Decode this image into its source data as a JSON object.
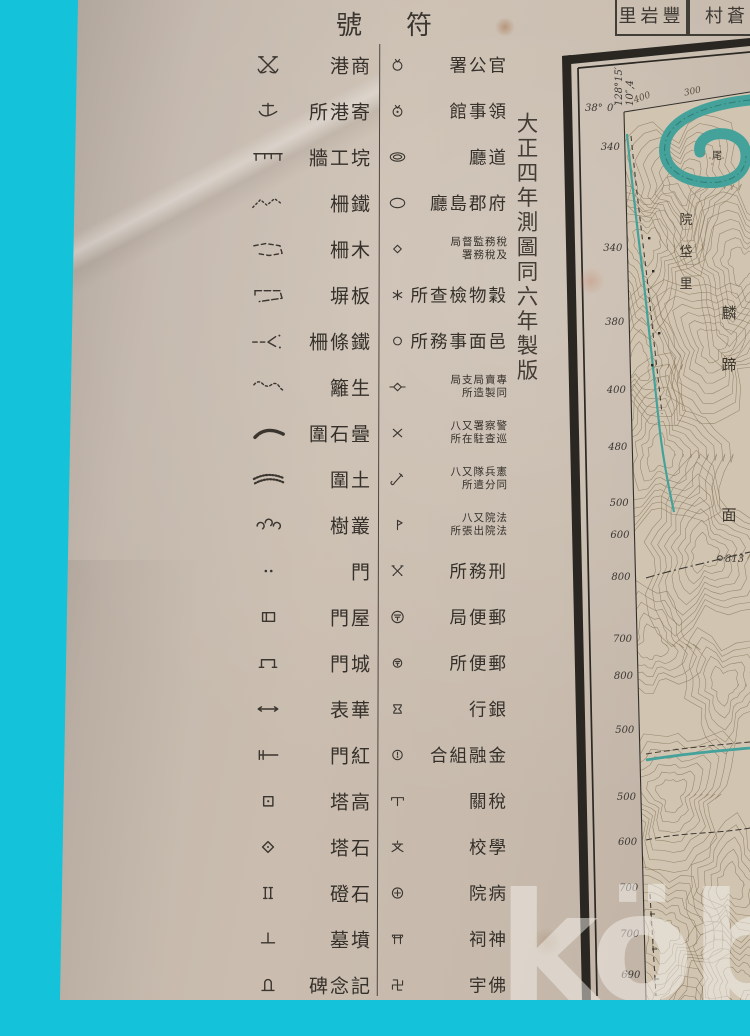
{
  "scene": {
    "background_color": "#14c2d9",
    "paper_color": "#c4b9ad",
    "ink_color": "#35302a",
    "water_color": "#45a29a",
    "contour_color": "#8a795d"
  },
  "legend": {
    "title_display": "號符",
    "rows": [
      {
        "left": {
          "symbol": "crossed-anchors",
          "label": "港商"
        },
        "right": {
          "symbol": "circle-ticks",
          "label": "署公官"
        }
      },
      {
        "left": {
          "symbol": "anchor",
          "label": "所港寄"
        },
        "right": {
          "symbol": "circle-dot-ticks",
          "label": "館事領"
        }
      },
      {
        "left": {
          "symbol": "masonry-wall",
          "label": "牆工垸"
        },
        "right": {
          "symbol": "double-ellipse",
          "label": "廳道"
        }
      },
      {
        "left": {
          "symbol": "iron-fence",
          "label": "柵鐵"
        },
        "right": {
          "symbol": "ellipse",
          "label": "廳島郡府"
        }
      },
      {
        "left": {
          "symbol": "wood-fence",
          "label": "柵木"
        },
        "right": {
          "symbol": "small-diamond",
          "label": "局督監務稅",
          "label2": "署務稅及"
        }
      },
      {
        "left": {
          "symbol": "board-fence",
          "label": "塀板"
        },
        "right": {
          "symbol": "grain-check",
          "label": "所查檢物穀"
        }
      },
      {
        "left": {
          "symbol": "wire-fence",
          "label": "柵條鐵"
        },
        "right": {
          "symbol": "small-circle",
          "label": "所務事面邑"
        }
      },
      {
        "left": {
          "symbol": "hedge",
          "label": "籬生"
        },
        "right": {
          "symbol": "diamond-bars",
          "label": "局支局賣專",
          "label2": "所造製同"
        }
      },
      {
        "left": {
          "symbol": "stone-enclosure",
          "label": "圍石曡"
        },
        "right": {
          "symbol": "x-mark",
          "label": "八又署察警",
          "label2": "所在駐查巡"
        }
      },
      {
        "left": {
          "symbol": "earth-enclosure",
          "label": "圍土"
        },
        "right": {
          "symbol": "sabre",
          "label": "八又隊兵憲",
          "label2": "所遣分同"
        }
      },
      {
        "left": {
          "symbol": "tree-clump",
          "label": "樹叢"
        },
        "right": {
          "symbol": "court-flag",
          "label": "八又院法",
          "label2": "所張出院法"
        }
      },
      {
        "left": {
          "symbol": "gate",
          "label": "門"
        },
        "right": {
          "symbol": "crossed-sabres",
          "label": "所務刑"
        }
      },
      {
        "left": {
          "symbol": "roofed-gate",
          "label": "門屋"
        },
        "right": {
          "symbol": "post-office-large",
          "label": "局便郵"
        }
      },
      {
        "left": {
          "symbol": "castle-gate",
          "label": "門城"
        },
        "right": {
          "symbol": "post-office-small",
          "label": "所便郵"
        }
      },
      {
        "left": {
          "symbol": "hwapyo",
          "label": "表華"
        },
        "right": {
          "symbol": "bank-weight",
          "label": "行銀"
        }
      },
      {
        "left": {
          "symbol": "red-gate",
          "label": "門紅"
        },
        "right": {
          "symbol": "finance-circle",
          "label": "合組融金"
        }
      },
      {
        "left": {
          "symbol": "high-pagoda",
          "label": "塔高"
        },
        "right": {
          "symbol": "customs-mark",
          "label": "關稅"
        }
      },
      {
        "left": {
          "symbol": "stone-pagoda",
          "label": "塔石"
        },
        "right": {
          "symbol": "school-mark",
          "label": "校學"
        }
      },
      {
        "left": {
          "symbol": "stone-steps",
          "label": "磴石"
        },
        "right": {
          "symbol": "hospital-mark",
          "label": "院病"
        }
      },
      {
        "left": {
          "symbol": "tomb",
          "label": "墓墳"
        },
        "right": {
          "symbol": "torii",
          "label": "祠神"
        }
      },
      {
        "left": {
          "symbol": "monument",
          "label": "碑念記"
        },
        "right": {
          "symbol": "manji",
          "label": "宇佛"
        }
      }
    ]
  },
  "imprint": {
    "text": "大正四年測圖同六年製版"
  },
  "adjoining_sheets": [
    {
      "label": "里岩豐"
    },
    {
      "label": "村蒼"
    }
  ],
  "map": {
    "corner_lat": "38°",
    "corner_lat_min": "0′",
    "corner_lon": "128°15′",
    "corner_lon_sec": "10″,4",
    "top_contour_labels": [
      "400",
      "300"
    ],
    "edge_contour_labels": [
      "340",
      "340",
      "380",
      "400",
      "480",
      "500",
      "600",
      "800",
      "700",
      "800",
      "500",
      "500",
      "600",
      "700",
      "700",
      "690"
    ],
    "spot_height": "813",
    "place_labels": [
      {
        "text": "尾"
      },
      {
        "text": "院垈里"
      },
      {
        "text": "麟蹄面"
      }
    ]
  },
  "watermark": {
    "text": "köb"
  }
}
